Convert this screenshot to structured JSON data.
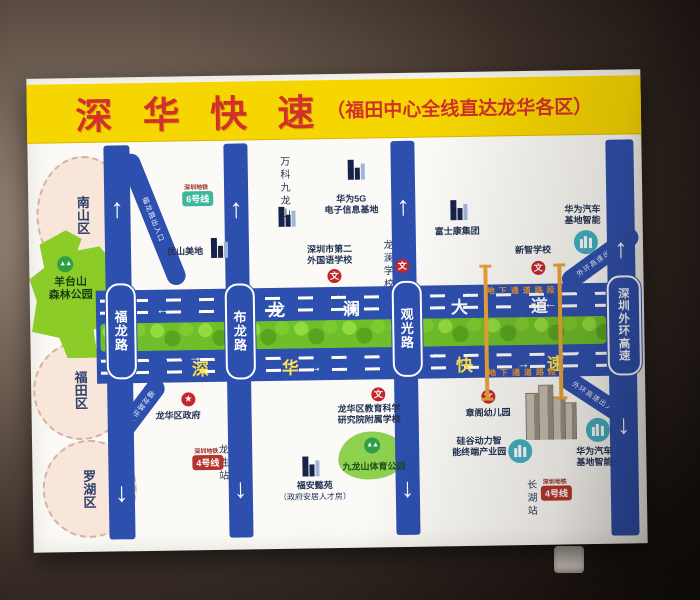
{
  "header": {
    "title": "深 华 快 速",
    "subtitle": "（福田中心全线直达龙华各区）"
  },
  "districts": {
    "nanshan": "南山区",
    "futian": "福田区",
    "luohu": "罗湖区"
  },
  "parks": {
    "yangtai_l1": "羊台山",
    "yangtai_l2": "森林公园",
    "jiulongshan": "九龙山体育公园"
  },
  "main_road": {
    "top_name": [
      "龙",
      "澜",
      "大",
      "道"
    ],
    "bottom_name": [
      "深",
      "华",
      "快",
      "速"
    ],
    "underground": "地下通道路段"
  },
  "roads": {
    "fulong": {
      "name": "福龙路",
      "to_top": "往南山",
      "to_bottom": "往福田"
    },
    "bulong": {
      "name": "布龙路",
      "to_top": "往南山",
      "to_bottom": "往坂田"
    },
    "guanguang": {
      "name": "观光路",
      "to_top": "往光明",
      "to_bottom": "往平湖"
    },
    "waihuan": {
      "name": "深圳外环高速",
      "to_top": "往光明南山方向",
      "to_bottom": "往龙岗方向"
    }
  },
  "ramps": {
    "nw": "福龙路出入口",
    "sw": "福龙路出入口",
    "ne": "外环高速出入口",
    "se": "外环高速出入口"
  },
  "pois": {
    "youshan": "优山美地",
    "vanke": "万科九龙山",
    "huawei5g_l1": "华为5G",
    "huawei5g_l2": "电子信息基地",
    "sfls_l1": "深圳市第二",
    "sfls_l2": "外国语学校",
    "longlan_school": "龙澜学校",
    "foxconn": "富士康集团",
    "xinzhi_school": "新智学校",
    "huawei_auto_l1": "华为汽车",
    "huawei_auto_l2": "基地智能",
    "longhua_gov": "龙华区政府",
    "edu_school_l1": "龙华区教育科学",
    "edu_school_l2": "研究院附属学校",
    "zhangge": "章阁幼儿园",
    "silicon_l1": "硅谷动力智",
    "silicon_l2": "能终端产业园",
    "fuan_l1": "福安懿苑",
    "fuan_l2": "（政府安居人才房）"
  },
  "metro": {
    "operator": "深圳地铁",
    "line6": "6号线",
    "line4": "4号线",
    "stations": {
      "yangtaishan_east": "羊台山东站",
      "longsheng": "龙胜站",
      "changhu": "长湖站"
    }
  },
  "icons": {
    "arrow_up": "↑",
    "arrow_down": "↓",
    "arrow_left": "←",
    "arrow_right": "→",
    "school_badge": "文",
    "gov_star": "★",
    "trees": "▲▲"
  },
  "colors": {
    "road_blue": "#2d4fae",
    "header_yellow": "#f6d600",
    "header_red": "#d2302a",
    "median_green": "#6fbf2a",
    "underground_orange": "#e8962e",
    "metro_line6": "#3eb79f",
    "metro_line4": "#b5342c"
  }
}
